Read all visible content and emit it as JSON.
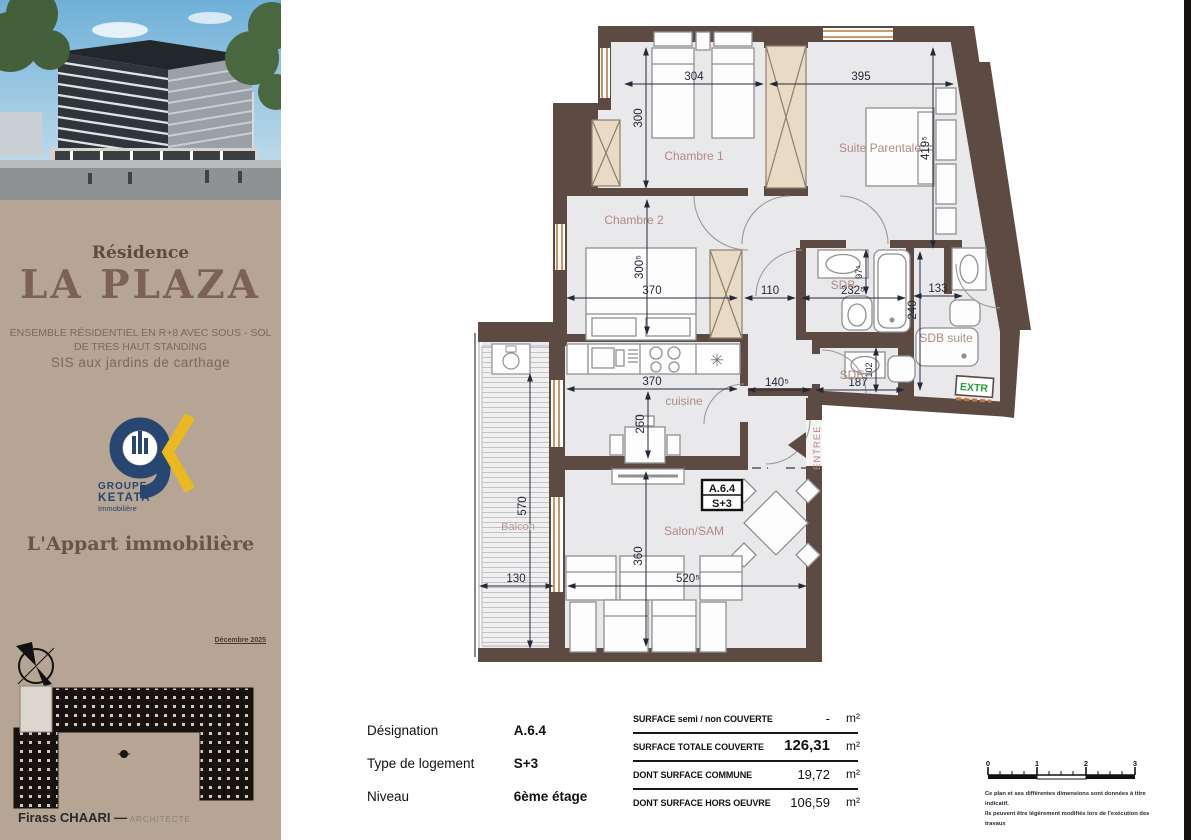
{
  "sidebar": {
    "residence": "Résidence",
    "title": "LA PLAZA",
    "subtitle1": "ENSEMBLE  RÉSIDENTIEL EN R+8 AVEC SOUS - SOL",
    "subtitle2": "DE TRES HAUT STANDING",
    "subtitle3": "SIS aux jardins de carthage",
    "logo_group": "GROUPE",
    "logo_name": "KETATA",
    "logo_sub": "Immobilière",
    "agency": "L'Appart immobilière",
    "date": "Décembre 2025",
    "architect_name": "Firass CHAARI",
    "architect_dash": "—",
    "architect_title": "ARCHITECTE"
  },
  "plan": {
    "labels": {
      "chambre1": "Chambre 1",
      "suite": "Suite Parentale",
      "chambre2": "Chambre 2",
      "sdb": "SDB",
      "sdb_suite": "SDB suite",
      "sde": "SDE",
      "cuisine": "cuisine",
      "salon": "Salon/SAM",
      "balcon": "Balcon",
      "entree": "ENTREE",
      "extr": "EXTR"
    },
    "unit": {
      "designation": "A.6.4",
      "type": "S+3"
    },
    "dims": {
      "chambre1_w": "304",
      "suite_w": "395",
      "chambre1_h": "300",
      "suite_h": "419⁵",
      "chambre2_h": "300⁵",
      "chambre2_w": "370",
      "hall_w": "110",
      "sdb_w": "232⁵",
      "sdb_h": "97⁵",
      "right_w": "133",
      "right_h": "240",
      "cuisine_w": "370",
      "entry_w": "140⁵",
      "sde_w": "187",
      "sde_h": "102",
      "cuisine_h": "260",
      "balcon_h": "570",
      "balcon_w": "130",
      "salon_h": "360",
      "salon_w": "520⁵"
    }
  },
  "info": {
    "rows": [
      {
        "label": "Désignation",
        "value": "A.6.4"
      },
      {
        "label": "Type de logement",
        "value": "S+3"
      },
      {
        "label": "Niveau",
        "value": "6ème étage"
      }
    ]
  },
  "surface": {
    "rows": [
      {
        "label": "SURFACE semi / non COUVERTE",
        "value": "-",
        "unit": "m²"
      },
      {
        "label": "SURFACE TOTALE COUVERTE",
        "value": "126,31",
        "unit": "m²"
      },
      {
        "label": "DONT SURFACE COMMUNE",
        "value": "19,72",
        "unit": "m²"
      },
      {
        "label": "DONT SURFACE  HORS OEUVRE",
        "value": "106,59",
        "unit": "m²"
      }
    ]
  },
  "scalebar": {
    "ticks": [
      "0",
      "1",
      "2",
      "3"
    ]
  },
  "disclaimer": {
    "line1": "Ce plan et ses différentes dimensions sont données à titre indicatif.",
    "line2": "Ils peuvent être légèrement modifiés lors de l'exécution des travaux"
  },
  "colors": {
    "wall": "#5d4b43",
    "room": "#e9e9eb",
    "label": "#b18a84",
    "window": "#c0763c",
    "beige": "#b6a595",
    "navy": "#274672",
    "yellow": "#eab81f",
    "extr_green": "#23a038",
    "dim_text": "#23283a"
  }
}
